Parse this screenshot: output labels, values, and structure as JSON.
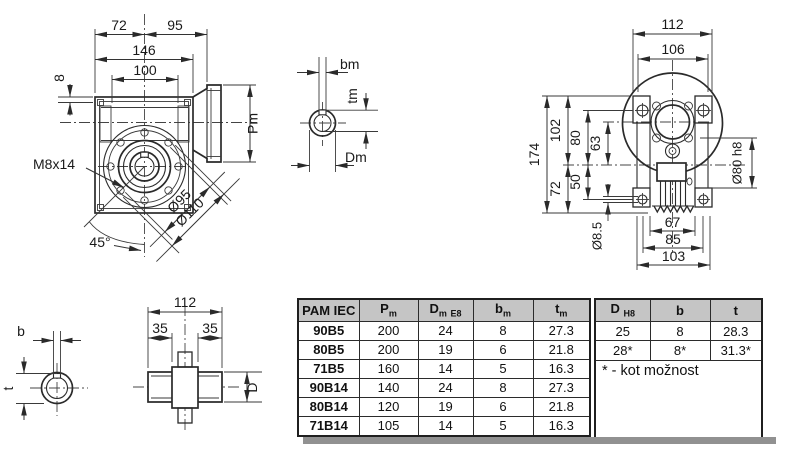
{
  "figures": {
    "front_view": {
      "dim_top_left": "72",
      "dim_top_right": "95",
      "dim_width": "146",
      "dim_bolt_span": "100",
      "dim_wall": "8",
      "thread_label": "M8x14",
      "angle_label": "45°",
      "bolt_circle_dia": "Ø95",
      "flange_dia": "Ø110",
      "motor_flange_dia": "Pm"
    },
    "motor_shaft_section": {
      "key_width": "bm",
      "key_depth": "tm",
      "shaft_dia": "Dm"
    },
    "side_view": {
      "dim_width_outer": "112",
      "dim_width_inner": "106",
      "dim_height_total": "174",
      "dim_height_upper": "102",
      "dim_bolt_top": "80",
      "dim_axis": "63",
      "dim_height_lower": "72",
      "dim_bolt_bottom": "50",
      "bolt_hole_dia": "Ø8.5",
      "dim_fins": "67",
      "dim_foot_inner": "85",
      "dim_foot": "103",
      "spigot_dia": "Ø80 h8"
    },
    "output_shaft_section": {
      "key_width": "b",
      "key_depth": "t"
    },
    "output_shaft": {
      "dim_length": "112",
      "dim_end_left": "35",
      "dim_end_right": "35",
      "shaft_dia": "D"
    }
  },
  "table": {
    "headers": {
      "pam": "PAM IEC",
      "pm_main": "P",
      "pm_sub": "m",
      "dm_main": "D",
      "dm_sub": "m",
      "dm_tol": "E8",
      "bm_main": "b",
      "bm_sub": "m",
      "tm_main": "t",
      "tm_sub": "m",
      "d_main": "D",
      "d_tol": "H8",
      "b": "b",
      "t": "t"
    },
    "rows": [
      {
        "pam": "90B5",
        "pm": "200",
        "dm": "24",
        "bm": "8",
        "tm": "27.3"
      },
      {
        "pam": "80B5",
        "pm": "200",
        "dm": "19",
        "bm": "6",
        "tm": "21.8"
      },
      {
        "pam": "71B5",
        "pm": "160",
        "dm": "14",
        "bm": "5",
        "tm": "16.3"
      },
      {
        "pam": "90B14",
        "pm": "140",
        "dm": "24",
        "bm": "8",
        "tm": "27.3"
      },
      {
        "pam": "80B14",
        "pm": "120",
        "dm": "19",
        "bm": "6",
        "tm": "21.8"
      },
      {
        "pam": "71B14",
        "pm": "105",
        "dm": "14",
        "bm": "5",
        "tm": "16.3"
      }
    ],
    "right_rows": [
      {
        "d": "25",
        "b": "8",
        "t": "28.3"
      },
      {
        "d": "28*",
        "b": "8*",
        "t": "31.3*"
      }
    ],
    "note": "* - kot možnost"
  },
  "colors": {
    "line": "#2a2a2a",
    "header_bg": "#c5c5c5",
    "shadow": "#919191",
    "background": "#ffffff"
  }
}
